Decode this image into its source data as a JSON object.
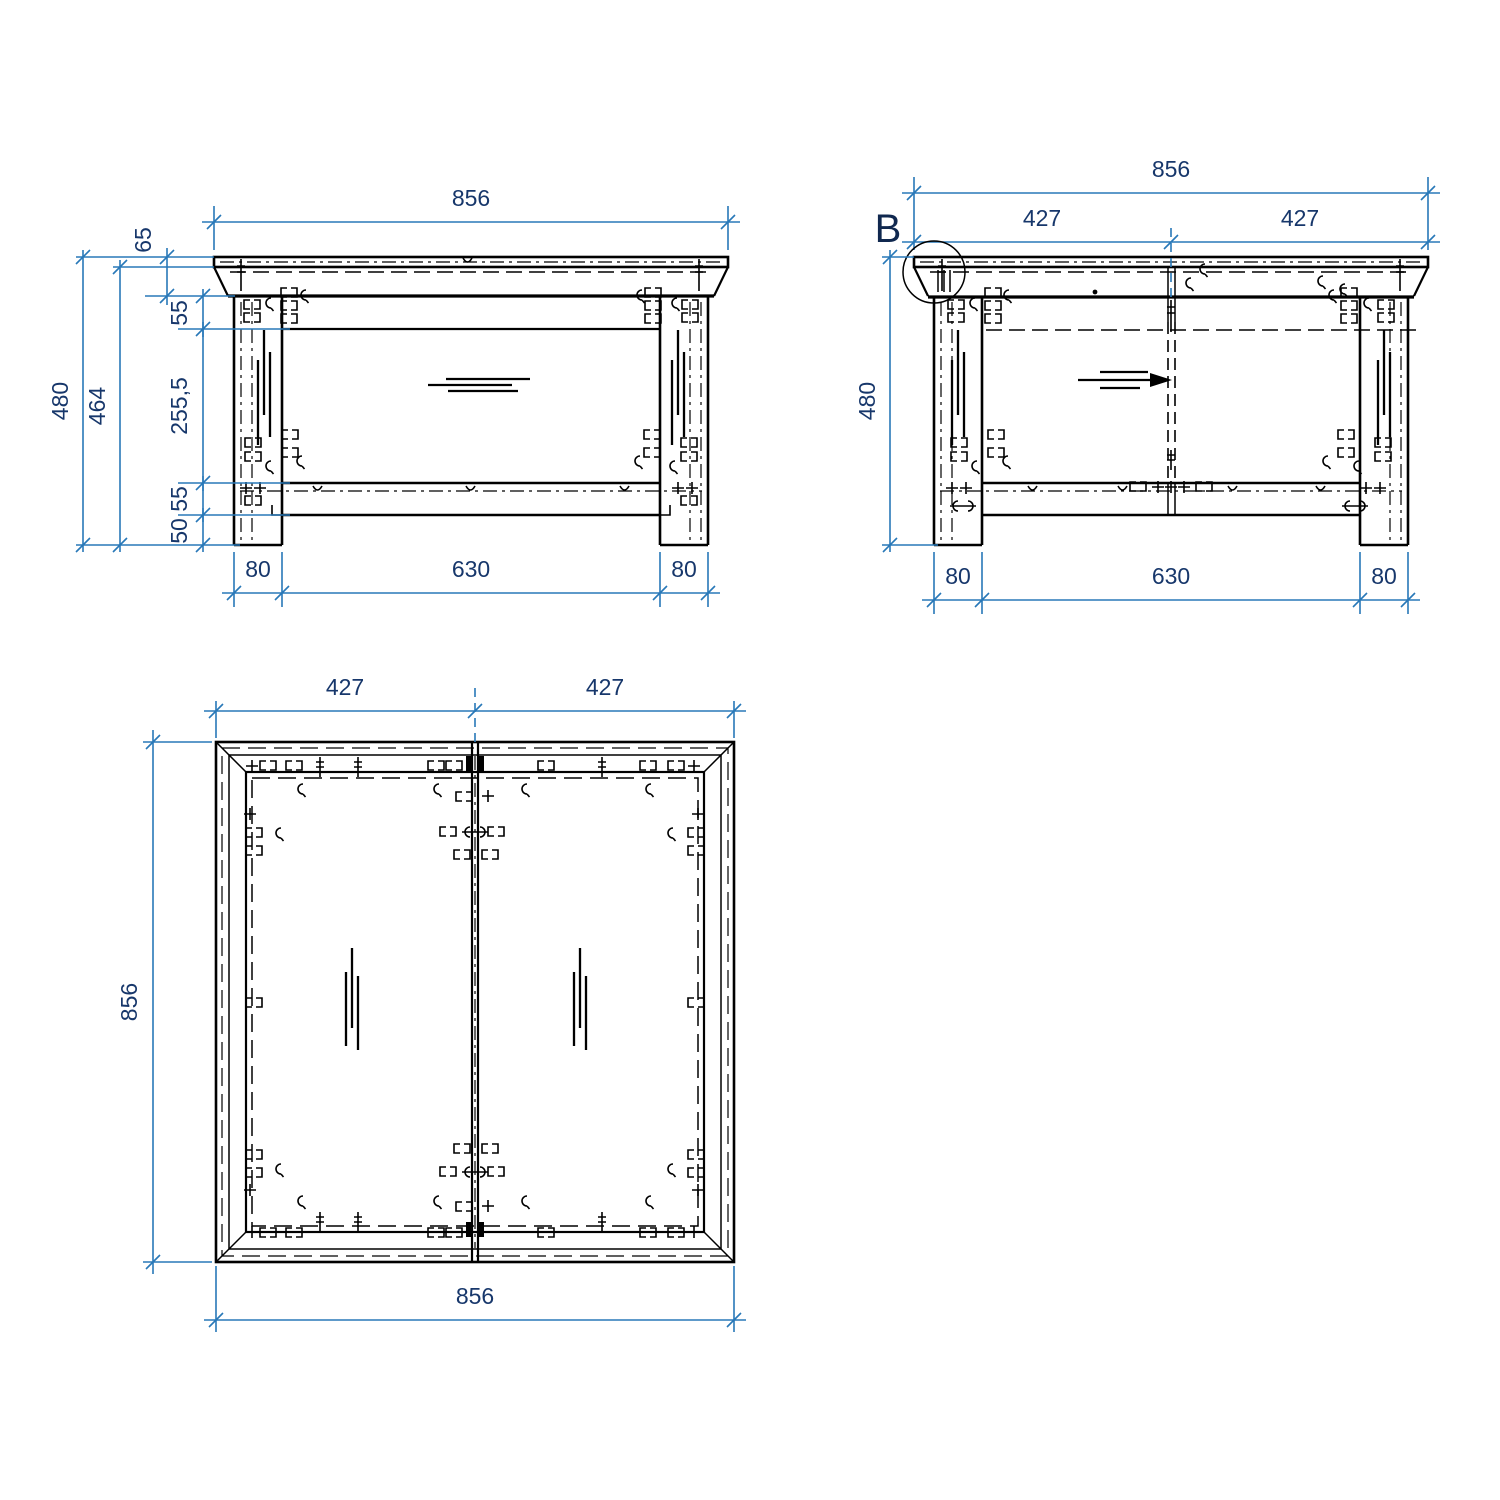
{
  "drawing": {
    "type": "furniture-assembly-technical-drawing",
    "colors": {
      "dimension_line": "#2878b8",
      "dimension_text": "#17376b",
      "line_work": "#000000",
      "background": "#ffffff"
    },
    "views": {
      "front": {
        "label": "front-elevation",
        "dims": {
          "width": "856",
          "top_thickness": "65",
          "apron": "55",
          "opening": "255,5",
          "rail": "55",
          "foot": "50",
          "height_total": "480",
          "height_under_top": "464",
          "leg_left": "80",
          "span": "630",
          "leg_right": "80"
        }
      },
      "side": {
        "label": "side-elevation",
        "detail_marker": "B",
        "dims": {
          "width": "856",
          "half_left": "427",
          "half_right": "427",
          "height_total": "480",
          "leg_left": "80",
          "span": "630",
          "leg_right": "80"
        }
      },
      "plan": {
        "label": "plan-view",
        "dims": {
          "half_left": "427",
          "half_right": "427",
          "depth": "856",
          "width": "856"
        }
      }
    }
  }
}
